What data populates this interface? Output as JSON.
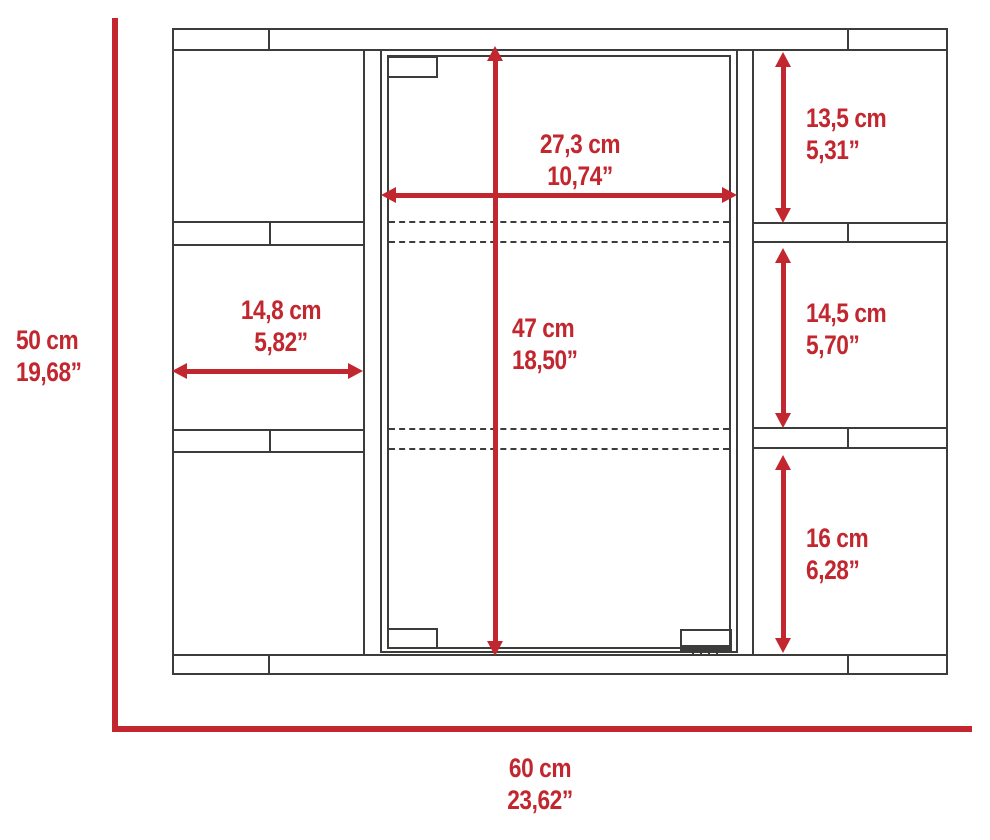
{
  "diagram": {
    "kind": "furniture-dimension-drawing",
    "subject": "mirrored medicine cabinet, front view",
    "accent_color": "#c2262e",
    "line_color": "#3c3c3b",
    "background_color": "#ffffff"
  },
  "dimensions": {
    "overall_height": {
      "cm": "50 cm",
      "inch": "19,68”"
    },
    "overall_width": {
      "cm": "60 cm",
      "inch": "23,62”"
    },
    "door_width": {
      "cm": "27,3 cm",
      "inch": "10,74”"
    },
    "door_height": {
      "cm": "47 cm",
      "inch": "18,50”"
    },
    "left_shelf_width": {
      "cm": "14,8 cm",
      "inch": "5,82”"
    },
    "right_top_shelf_height": {
      "cm": "13,5 cm",
      "inch": "5,31”"
    },
    "right_middle_shelf_height": {
      "cm": "14,5 cm",
      "inch": "5,70”"
    },
    "right_bottom_shelf_height": {
      "cm": "16 cm",
      "inch": "6,28”"
    }
  }
}
